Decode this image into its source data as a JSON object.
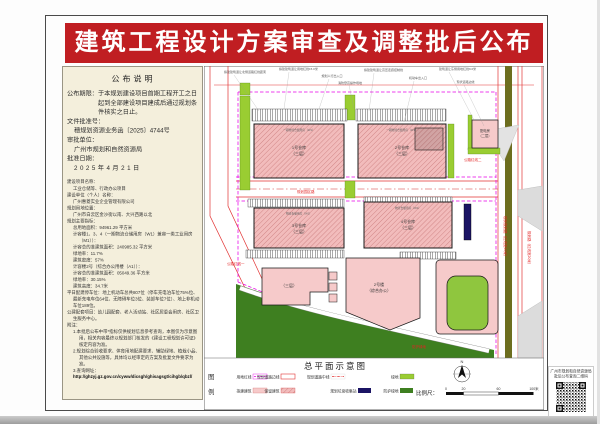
{
  "page": {
    "banner_title": "建筑工程设计方案审查及调整批后公布"
  },
  "notice_panel": {
    "title": "公布说明",
    "period_full": "公布期限：于本规划建设项目首期工程开工之日起到全部建设项目建成后通过规划条件核实之日止。",
    "file_label": "文件批准号：",
    "file_no": "穗规划资源业务函〔2025〕4744号",
    "authority_label": "审批单位：",
    "authority": "广州市规划和自然资源局",
    "date_label": "批准日期：",
    "date": "2025年4月21日"
  },
  "detail_panel": {
    "lines": [
      {
        "t": "建设项目名称：",
        "i": 0
      },
      {
        "t": "工业仓储等、行政办公项目",
        "i": 1
      },
      {
        "t": "建设单位（个人）名称：",
        "i": 0
      },
      {
        "t": "广州惠菱实业企业管理有限公司",
        "i": 1
      },
      {
        "t": "规划用地位置：",
        "i": 0
      },
      {
        "t": "广州市白云区金沙街以南、大兴西路以北",
        "i": 1
      },
      {
        "t": "规划主要指标：",
        "i": 0
      },
      {
        "t": "总用地面积：94961.29 平方米",
        "i": 1
      },
      {
        "t": "计容楼1、3、4（一期物流仓储用房（W1）兼容一类工业用房（M1））：",
        "i": 1
      },
      {
        "t": "计容总的准建筑面积：240985.32 平方米",
        "i": 1
      },
      {
        "t": "绿地率：11.7%",
        "i": 1
      },
      {
        "t": "建筑密度：57%",
        "i": 1
      },
      {
        "t": "计容楼2号（综合办公用楼（A1））：",
        "i": 1
      },
      {
        "t": "计容总的准建筑面积：05049.36 平方米",
        "i": 1
      },
      {
        "t": "绿地率：30.15%",
        "i": 1
      },
      {
        "t": "建筑高度：34.7米",
        "i": 1
      },
      {
        "t": "平日配建停车位：地上机动车总共807位（停车充电泊车位75%位、最新充电车位64位、无障碍车位3位、装卸车位7位）、地上非机动车位189位。",
        "i": 0
      },
      {
        "t": "公建配套项目：幼儿园配套、老人活动站、社区居委会用房、社区卫生服务中心。",
        "i": 0
      },
      {
        "t": "附注：",
        "i": 0
      },
      {
        "t": "1.本批后公布中带*指标仅供规划信息参考查询，本图仅为示意图用，相关内容最终以规划部门核发的《建设工程规划许可证》核定内容为准。",
        "i": 1
      },
      {
        "t": "2.规划综合验收要求、体育用地配建要求、辅助绿地、植栽小品、其他公共设施等，具体均以经审定的方案及批复文件要求为准。",
        "i": 1
      },
      {
        "t": "3.查询网址：",
        "i": 1
      }
    ],
    "url": "http://ghzyj.gz.gov.cn/cyww/dicsgh/ghisagsgt/cihgb/qbzl/"
  },
  "map": {
    "annotations": [
      "拟建建筑退让北侧道路红线距离",
      "拟建建筑退让用地红线15.0米",
      "规划人行出入口",
      "拟建建筑退让高压走廊控制线",
      "机动车出入口",
      "建筑退让东侧用地红线9.0米",
      "现状道路边线",
      "消防登高操作场地"
    ],
    "block_top1": "一期物流仓储用房（W1）",
    "block_top2": "一期物流仓储用房（W1）",
    "block_top3": "物流仓储用房（W1）",
    "block_top4": "物流仓储用房（W1）",
    "blocks": {
      "b1": "1号仓库",
      "b1s": "（三层）",
      "b2": "2号仓库",
      "b2s": "（三层）",
      "b3": "3号仓库",
      "b3s": "（三层）",
      "b4": "4号仓库",
      "b4s": "（三层）",
      "b5": "配电房",
      "b5s": "（二层）",
      "p1": "（三层）",
      "p2": "2号楼",
      "p2s": "（综合办公）"
    },
    "road_labels": {
      "r1": "公路红线二",
      "r2": "公路红线一",
      "r3": "现状规划路（红线宽40米）",
      "r4": "规划路（红线宽20米）",
      "r5": "防护绿地",
      "r6": "规划园区路"
    }
  },
  "legend": {
    "panel_char1": "图",
    "panel_char2": "例",
    "title": "总平面示意图",
    "row1": [
      {
        "label": "用地红线"
      },
      {
        "label": "规划道路边线"
      },
      {
        "label": "规划道路中线"
      },
      {
        "label": "绿地"
      }
    ],
    "row2": [
      {
        "label": "拟建建筑"
      },
      {
        "label": "保留建筑"
      },
      {
        "label": "规划垃圾收集站"
      },
      {
        "label": "防护绿地"
      }
    ],
    "scale_label": "比例尺：",
    "ticks": [
      "0",
      "20",
      "60",
      "100米"
    ],
    "north": "N"
  },
  "qr": {
    "caption1": "广州市规划和自然资源局",
    "caption2": "批后公布查询二维码"
  },
  "colors": {
    "banner_red": "#c01e22",
    "beige": "#f4efdc",
    "boundary_magenta": "#e800e8",
    "road_red": "#e23333",
    "green_light": "#9acd32",
    "green_dark": "#3e7f20",
    "navy": "#1b1464",
    "building_pink": "#f6caca",
    "retained_pink": "#f2bcbc",
    "olive_median": "#6d6e1f"
  }
}
